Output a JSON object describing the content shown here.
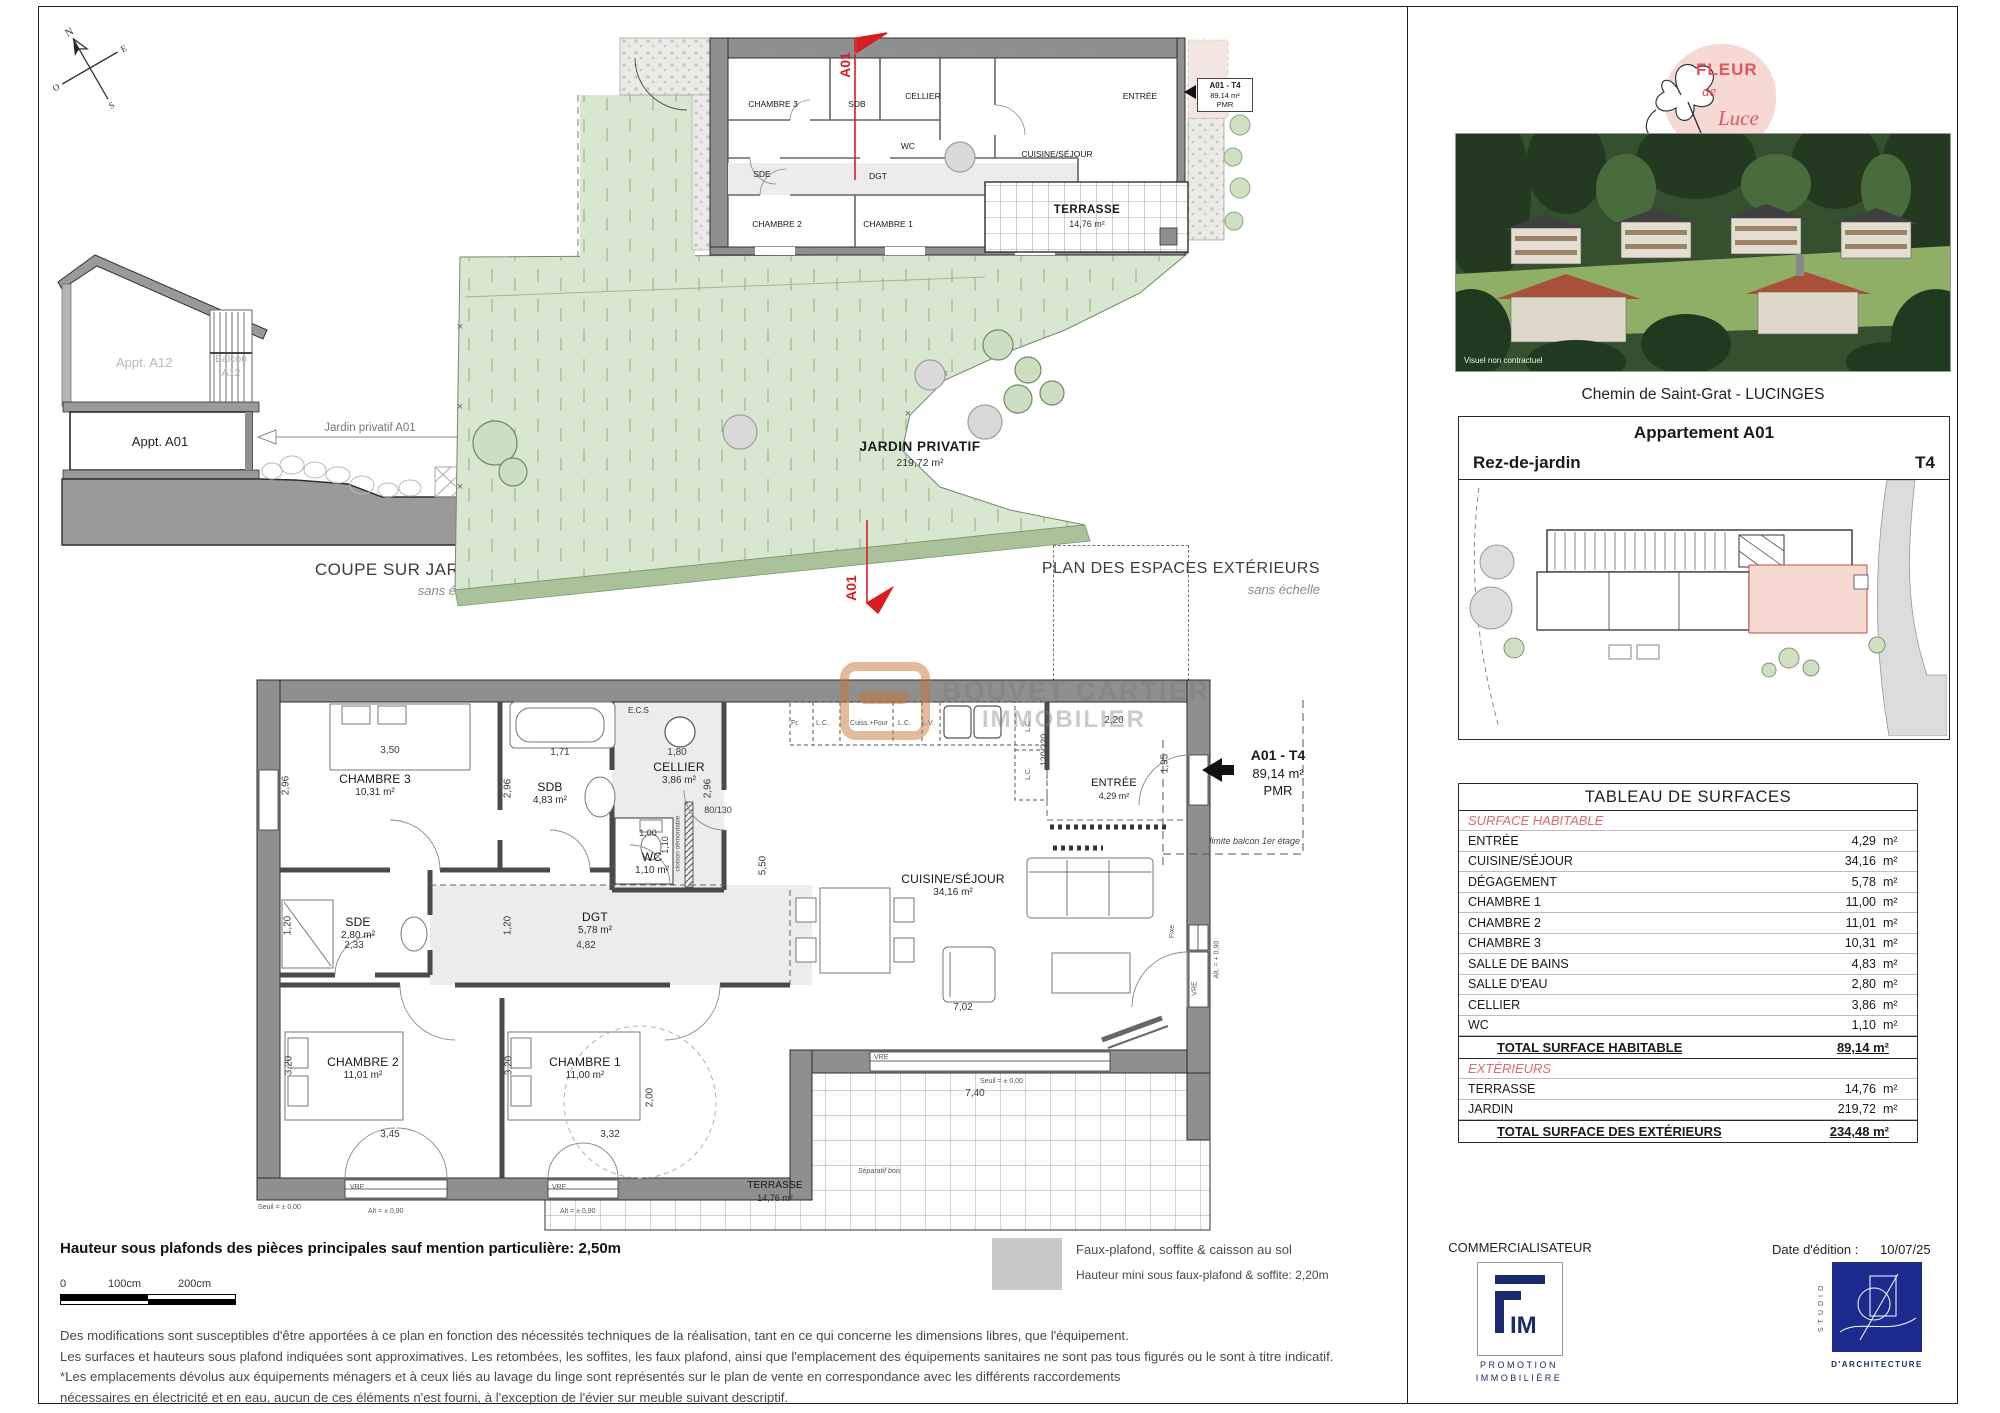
{
  "compass": {
    "n": "N",
    "e": "E",
    "s": "S",
    "o": "O"
  },
  "watermark": {
    "line1": "BOUVET CARTIER",
    "line2": "IMMOBILIER"
  },
  "coupe": {
    "title": "COUPE SUR JARDIN",
    "subtitle": "sans échelle",
    "appt_a12": "Appt. A12",
    "balcon_l1": "Balcon",
    "balcon_l2": "A12",
    "appt_a01": "Appt. A01",
    "dim_label": "Jardin privatif A01"
  },
  "ext_plan": {
    "title": "PLAN DES ESPACES EXTÉRIEURS",
    "subtitle": "sans échelle",
    "jardin_name": "JARDIN PRIVATIF",
    "jardin_area": "219,72 m²",
    "terrasse_name": "TERRASSE",
    "terrasse_area": "14,76 m²",
    "section": "A01",
    "tag": {
      "l1": "A01 - T4",
      "l2": "89,14 m²",
      "l3": "PMR"
    },
    "rooms": {
      "ch3": "CHAMBRE 3",
      "sdb": "SDB",
      "cellier": "CELLIER",
      "wc": "WC",
      "sde": "SDE",
      "dgt": "DGT",
      "ch2": "CHAMBRE 2",
      "ch1": "CHAMBRE 1",
      "cuisine": "CUISINE/SÉJOUR",
      "entree": "ENTRÉE"
    }
  },
  "main_plan": {
    "tag": {
      "l1": "A01 - T4",
      "l2": "89,14 m²",
      "l3": "PMR"
    },
    "limite": "limite balcon 1er étage",
    "rooms": {
      "ch3": {
        "name": "CHAMBRE 3",
        "area": "10,31 m²"
      },
      "sdb": {
        "name": "SDB",
        "area": "4,83 m²"
      },
      "cellier": {
        "name": "CELLIER",
        "area": "3,86 m²"
      },
      "wc": {
        "name": "WC",
        "area": "1,10 m²"
      },
      "sde": {
        "name": "SDE",
        "area": "2,80 m²"
      },
      "dgt": {
        "name": "DGT",
        "area": "5,78 m²"
      },
      "ch2": {
        "name": "CHAMBRE 2",
        "area": "11,01 m²"
      },
      "ch1": {
        "name": "CHAMBRE 1",
        "area": "11,00 m²"
      },
      "cuisine": {
        "name": "CUISINE/SÉJOUR",
        "area": "34,16 m²"
      },
      "entree": {
        "name": "ENTRÉE",
        "area": "4,29 m²"
      },
      "terrasse": {
        "name": "TERRASSE",
        "area": "14,76 m²"
      }
    },
    "kitchen": {
      "fr": "Fr.",
      "lc": "L.C.",
      "four": "Cuiss.+Four",
      "lv": "L.V.",
      "ecs": "E.C.S"
    },
    "dims": {
      "ch3_w": "3,50",
      "ch3_h": "2,96",
      "sdb_w": "1,71",
      "sdb_h": "2,96",
      "cellier_w": "1,80",
      "cellier_h": "2,96",
      "p80": "80/130",
      "cloison": "cloison démontable",
      "wc_w": "1,00",
      "wc_h": "1,10",
      "sde_w": "2,33",
      "sde_h": "1,20",
      "dgt_w": "4,82",
      "dgt_h": "1,20",
      "ch2_w": "3,45",
      "ch2_h": "3,20",
      "ch1_w": "3,32",
      "ch1_h": "3,20",
      "cuisine_w": "7,02",
      "h550": "5,50",
      "terr_w": "7,40",
      "terr_h": "2,00",
      "entree_w": "2,20",
      "entree_h": "1,95",
      "p120": "120/220"
    },
    "annot": {
      "vre": "VRE",
      "fixe": "Fixe",
      "alt090": "Alt = ± 0,90",
      "altp090": "Alt. = + 0,90",
      "seuil": "Seuil = ± 0,00",
      "separatif": "Séparatif bois"
    }
  },
  "header": {
    "logo": {
      "l1": "FLEUR",
      "l2": "de",
      "l3": "Luce"
    },
    "photo_caption": "Visuel non contractuel",
    "address": "Chemin de Saint-Grat - LUCINGES"
  },
  "unit_box": {
    "title": "Appartement A01",
    "level": "Rez-de-jardin",
    "type": "T4"
  },
  "surface_table": {
    "title": "TABLEAU DE SURFACES",
    "section1": "SURFACE HABITABLE",
    "unit": "m²",
    "rows1": [
      [
        "ENTRÉE",
        "4,29"
      ],
      [
        "CUISINE/SÉJOUR",
        "34,16"
      ],
      [
        "DÉGAGEMENT",
        "5,78"
      ],
      [
        "CHAMBRE 1",
        "11,00"
      ],
      [
        "CHAMBRE 2",
        "11,01"
      ],
      [
        "CHAMBRE 3",
        "10,31"
      ],
      [
        "SALLE DE BAINS",
        "4,83"
      ],
      [
        "SALLE D'EAU",
        "2,80"
      ],
      [
        "CELLIER",
        "3,86"
      ],
      [
        "WC",
        "1,10"
      ]
    ],
    "total1_label": "TOTAL SURFACE HABITABLE",
    "total1_value": "89,14 m²",
    "section2": "EXTÉRIEURS",
    "rows2": [
      [
        "TERRASSE",
        "14,76"
      ],
      [
        "JARDIN",
        "219,72"
      ]
    ],
    "total2_label": "TOTAL SURFACE DES EXTÉRIEURS",
    "total2_value": "234,48 m²"
  },
  "footer": {
    "note_bold": "Hauteur sous plafonds des pièces principales sauf mention particulière: 2,50m",
    "scale": {
      "s0": "0",
      "s100": "100cm",
      "s200": "200cm"
    },
    "legend": {
      "line1": "Faux-plafond, soffite & caisson au sol",
      "line2": "Hauteur mini sous faux-plafond & soffite: 2,20m"
    },
    "disclaimer": [
      "Des modifications sont susceptibles d'être apportées à ce plan en fonction des nécessités techniques de la réalisation, tant en ce qui concerne les dimensions libres, que l'équipement.",
      "Les surfaces et hauteurs sous plafond indiquées sont approximatives. Les retombées, les soffites, les faux plafond, ainsi que l'emplacement des équipements sanitaires ne sont pas tous figurés ou le sont à titre indicatif.",
      "*Les emplacements dévolus aux équipements ménagers et à ceux liés au lavage du linge sont représentés sur le plan de vente en correspondance avec les différents raccordements",
      "nécessaires en électricité et en eau, aucun de ces éléments n'est fourni, à l'exception de l'évier sur meuble suivant descriptif."
    ],
    "commercialisateur": "COMMERCIALISATEUR",
    "fim": {
      "name": "IM",
      "sub1": "PROMOTION",
      "sub2": "IMMOBILIÈRE"
    },
    "date_label": "Date d'édition :",
    "date_value": "10/07/25",
    "studio": {
      "vertical": "STUDIO",
      "sub": "D'ARCHITECTURE"
    }
  }
}
